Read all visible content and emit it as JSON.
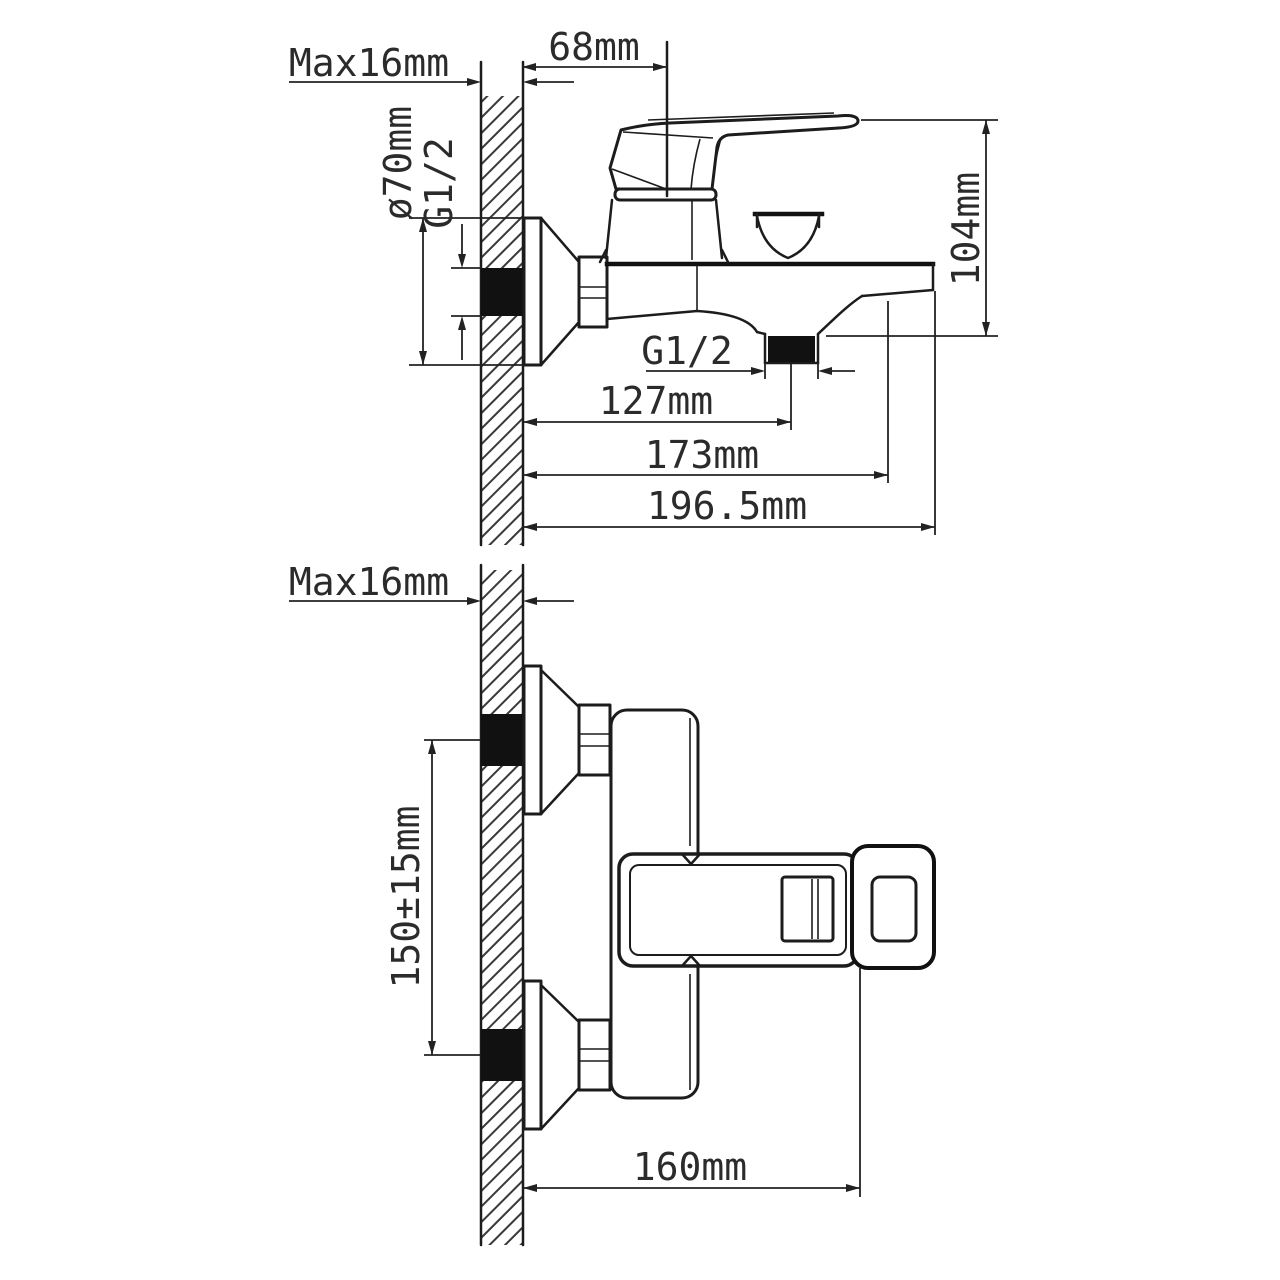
{
  "colors": {
    "line": "#1c1c1c",
    "text": "#2b2b2b",
    "seal": "#111111",
    "background": "#ffffff"
  },
  "top_view": {
    "labels": {
      "wall_thickness": "Max16mm",
      "center_offset": "68mm",
      "escutcheon_diameter": "ø70mm",
      "inlet_thread": "G1/2",
      "total_height": "104mm",
      "outlet_thread": "G1/2",
      "outlet_center_depth": "127mm",
      "spout_depth": "173mm",
      "total_depth": "196.5mm"
    }
  },
  "bottom_view": {
    "labels": {
      "wall_thickness": "Max16mm",
      "inlet_spacing": "150±15mm",
      "body_length": "160mm"
    }
  }
}
